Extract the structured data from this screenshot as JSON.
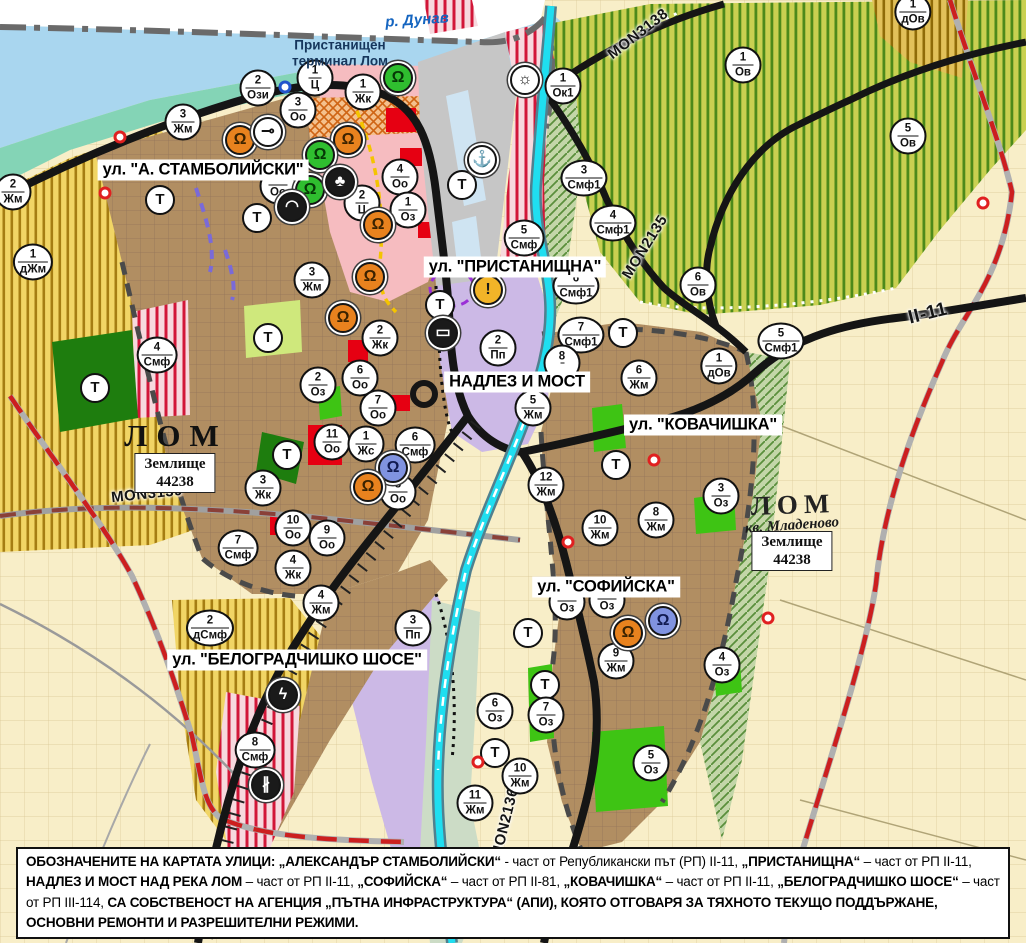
{
  "palette": {
    "residential_brown": "#b18e62",
    "mixed_function_red_stripe": "#d21638",
    "center_pink": "#f6bcc0",
    "production_lavender": "#ccb9e6",
    "park_green": "#3ec414",
    "vineyard_green_stripe": "#4c8a1b",
    "farmland_yellow_stripe": "#a57d12",
    "danube_blue": "#a9d6ef",
    "lom_river_cyan": "#1fdef0",
    "road_black": "#151515",
    "planned_route_red": "#cc1f1f"
  },
  "area_labels": [
    {
      "name": "river-danube-label",
      "t": "р. Дунав",
      "cls": "river-label",
      "x": 417,
      "y": 20,
      "rot": -4
    },
    {
      "name": "port-terminal-label",
      "t": "Пристанищен\nтерминал Лом",
      "cls": "port-label",
      "x": 340,
      "y": 53
    },
    {
      "name": "city-lom-label",
      "t": "ЛОМ",
      "cls": "city-label",
      "x": 176,
      "y": 436
    },
    {
      "name": "zemlishte-44238-label",
      "t": "Землище\n44238",
      "cls": "zemlishte-box",
      "x": 175,
      "y": 473
    },
    {
      "name": "city-lom-mladenovo-label",
      "t": "ЛОМ",
      "cls": "city-label city2",
      "x": 793,
      "y": 505,
      "rot": -2
    },
    {
      "name": "kv-mladenovo-label",
      "t": "кв. Младеново",
      "cls": "kv-label",
      "x": 792,
      "y": 526,
      "rot": -4
    },
    {
      "name": "zemlishte-44238-mladenovo-label",
      "t": "Землище\n44238",
      "cls": "zemlishte-box",
      "x": 792,
      "y": 551
    }
  ],
  "road_labels": [
    {
      "name": "road-label-mon3138",
      "t": "MON3138",
      "x": 638,
      "y": 34,
      "rot": -38
    },
    {
      "name": "road-label-mon2135",
      "t": "MON2135",
      "x": 645,
      "y": 247,
      "rot": -58
    },
    {
      "name": "road-label-mon3139",
      "t": "MON3139",
      "x": 147,
      "y": 494,
      "rot": -6
    },
    {
      "name": "road-label-mon2136",
      "t": "MON2136",
      "x": 505,
      "y": 823,
      "rot": -76
    },
    {
      "name": "road-label-ii-11",
      "t": "II-11",
      "cls": "big",
      "x": 928,
      "y": 314,
      "rot": -14
    }
  ],
  "street_labels": [
    {
      "name": "street-label-stamboliyski",
      "t": "ул. \"А. СТАМБОЛИЙСКИ\"",
      "x": 203,
      "y": 170
    },
    {
      "name": "street-label-pristanishtna",
      "t": "ул. \"ПРИСТАНИЩНА\"",
      "x": 515,
      "y": 267
    },
    {
      "name": "street-label-nadlez-i-most",
      "t": "НАДЛЕЗ И МОСТ",
      "x": 517,
      "y": 382
    },
    {
      "name": "street-label-kovachishka",
      "t": "ул. \"КОВАЧИШКА\"",
      "x": 703,
      "y": 425
    },
    {
      "name": "street-label-sofiyska",
      "t": "ул. \"СОФИЙСКА\"",
      "x": 606,
      "y": 587
    },
    {
      "name": "street-label-belogradchishko",
      "t": "ул. \"БЕЛОГРАДЧИШКО ШОСЕ\"",
      "x": 297,
      "y": 660
    }
  ],
  "zone_markers": [
    {
      "num": "2",
      "abbr": "Ози",
      "x": 258,
      "y": 88
    },
    {
      "num": "1",
      "abbr": "Ц",
      "x": 315,
      "y": 78
    },
    {
      "num": "1",
      "abbr": "Жк",
      "x": 363,
      "y": 92
    },
    {
      "num": "3",
      "abbr": "Оо",
      "x": 298,
      "y": 110
    },
    {
      "num": "3",
      "abbr": "Жм",
      "x": 183,
      "y": 122
    },
    {
      "num": "2",
      "abbr": "Жм",
      "x": 13,
      "y": 192
    },
    {
      "num": "1",
      "abbr": "дЖм",
      "x": 33,
      "y": 262
    },
    {
      "num": "",
      "abbr": "Оо",
      "x": 278,
      "y": 186
    },
    {
      "num": "4",
      "abbr": "Оо",
      "x": 400,
      "y": 177
    },
    {
      "num": "2",
      "abbr": "Ц",
      "x": 362,
      "y": 203
    },
    {
      "num": "1",
      "abbr": "Оз",
      "x": 408,
      "y": 210
    },
    {
      "num": "3",
      "abbr": "Жм",
      "x": 312,
      "y": 280
    },
    {
      "num": "Т",
      "cls": "single",
      "x": 160,
      "y": 200
    },
    {
      "num": "Т",
      "cls": "single",
      "x": 257,
      "y": 218
    },
    {
      "num": "1",
      "abbr": "Ок1",
      "x": 563,
      "y": 86
    },
    {
      "num": "3",
      "abbr": "Смф1",
      "x": 584,
      "y": 178
    },
    {
      "num": "4",
      "abbr": "Смф1",
      "x": 613,
      "y": 223
    },
    {
      "num": "5",
      "abbr": "Смф",
      "x": 524,
      "y": 238
    },
    {
      "num": "6",
      "abbr": "Смф1",
      "x": 576,
      "y": 286
    },
    {
      "num": "1",
      "abbr": "Ов",
      "x": 743,
      "y": 65
    },
    {
      "num": "5",
      "abbr": "Ов",
      "x": 908,
      "y": 136
    },
    {
      "num": "1",
      "abbr": "дОв",
      "x": 913,
      "y": 12
    },
    {
      "num": "6",
      "abbr": "Ов",
      "x": 698,
      "y": 285
    },
    {
      "num": "Т",
      "cls": "single",
      "x": 462,
      "y": 185
    },
    {
      "num": "Т",
      "cls": "single",
      "x": 440,
      "y": 305
    },
    {
      "num": "2",
      "abbr": "Пп",
      "x": 498,
      "y": 348
    },
    {
      "num": "Т",
      "cls": "single",
      "x": 623,
      "y": 333
    },
    {
      "num": "7",
      "abbr": "Смф1",
      "x": 581,
      "y": 335
    },
    {
      "num": "8",
      "abbr": "",
      "x": 562,
      "y": 363
    },
    {
      "num": "5",
      "abbr": "Жм",
      "x": 533,
      "y": 408
    },
    {
      "num": "6",
      "abbr": "Жм",
      "x": 639,
      "y": 378
    },
    {
      "num": "1",
      "abbr": "дОв",
      "x": 719,
      "y": 366
    },
    {
      "num": "5",
      "abbr": "Смф1",
      "x": 781,
      "y": 341
    },
    {
      "num": "12",
      "abbr": "Жм",
      "x": 546,
      "y": 485
    },
    {
      "num": "10",
      "abbr": "Жм",
      "x": 600,
      "y": 528
    },
    {
      "num": "8",
      "abbr": "Жм",
      "x": 656,
      "y": 520
    },
    {
      "num": "3",
      "abbr": "Оз",
      "x": 721,
      "y": 496
    },
    {
      "num": "Т",
      "cls": "single",
      "x": 616,
      "y": 465
    },
    {
      "num": "4",
      "abbr": "Смф",
      "x": 157,
      "y": 355
    },
    {
      "num": "Т",
      "cls": "single",
      "x": 95,
      "y": 388
    },
    {
      "num": "Т",
      "cls": "single",
      "x": 268,
      "y": 338
    },
    {
      "num": "Т",
      "cls": "single",
      "x": 287,
      "y": 455
    },
    {
      "num": "2",
      "abbr": "Оз",
      "x": 318,
      "y": 385
    },
    {
      "num": "6",
      "abbr": "Оо",
      "x": 360,
      "y": 378
    },
    {
      "num": "2",
      "abbr": "Жк",
      "x": 380,
      "y": 338
    },
    {
      "num": "7",
      "abbr": "Оо",
      "x": 378,
      "y": 408
    },
    {
      "num": "11",
      "abbr": "Оо",
      "x": 332,
      "y": 442
    },
    {
      "num": "1",
      "abbr": "Жс",
      "x": 366,
      "y": 444
    },
    {
      "num": "6",
      "abbr": "Смф",
      "x": 415,
      "y": 445
    },
    {
      "num": "8",
      "abbr": "Оо",
      "x": 398,
      "y": 492
    },
    {
      "num": "3",
      "abbr": "Жк",
      "x": 263,
      "y": 488
    },
    {
      "num": "10",
      "abbr": "Оо",
      "x": 293,
      "y": 528
    },
    {
      "num": "9",
      "abbr": "Оо",
      "x": 327,
      "y": 538
    },
    {
      "num": "7",
      "abbr": "Смф",
      "x": 238,
      "y": 548
    },
    {
      "num": "4",
      "abbr": "Жк",
      "x": 293,
      "y": 568
    },
    {
      "num": "4",
      "abbr": "Жм",
      "x": 321,
      "y": 603
    },
    {
      "num": "2",
      "abbr": "дСмф",
      "x": 210,
      "y": 628
    },
    {
      "num": "3",
      "abbr": "Пп",
      "x": 413,
      "y": 628
    },
    {
      "num": "8",
      "abbr": "Смф",
      "x": 255,
      "y": 750
    },
    {
      "num": "6",
      "abbr": "Оз",
      "x": 495,
      "y": 711
    },
    {
      "num": "Т",
      "cls": "single",
      "x": 495,
      "y": 753
    },
    {
      "num": "11",
      "abbr": "Жм",
      "x": 475,
      "y": 803
    },
    {
      "num": "Т",
      "cls": "single",
      "x": 528,
      "y": 633
    },
    {
      "num": "Т",
      "cls": "single",
      "x": 545,
      "y": 685
    },
    {
      "num": "7",
      "abbr": "Оз",
      "x": 546,
      "y": 715
    },
    {
      "num": "10",
      "abbr": "Жм",
      "x": 520,
      "y": 776
    },
    {
      "num": "9",
      "abbr": "Жм",
      "x": 616,
      "y": 661
    },
    {
      "num": "5",
      "abbr": "Оз",
      "x": 651,
      "y": 763
    },
    {
      "num": "4",
      "abbr": "Оз",
      "x": 722,
      "y": 665
    },
    {
      "num": "",
      "abbr": "Оз",
      "x": 567,
      "y": 602
    },
    {
      "num": "",
      "abbr": "Оз",
      "x": 607,
      "y": 600
    }
  ],
  "poi_markers": [
    {
      "name": "landmark-icon-green",
      "glyph": "Ω",
      "bg": "#2fbe2f",
      "fg": "#063806",
      "x": 398,
      "y": 78
    },
    {
      "name": "landmark-icon-orange",
      "glyph": "Ω",
      "bg": "#e8821e",
      "fg": "#3a2200",
      "x": 240,
      "y": 140
    },
    {
      "name": "landmark-icon-orange",
      "glyph": "Ω",
      "bg": "#e8821e",
      "fg": "#3a2200",
      "x": 348,
      "y": 140
    },
    {
      "name": "key-icon",
      "glyph": "⊸",
      "bg": "#ffffff",
      "fg": "#111111",
      "x": 268,
      "y": 132
    },
    {
      "name": "landmark-icon-green",
      "glyph": "Ω",
      "bg": "#2fbe2f",
      "fg": "#063806",
      "x": 320,
      "y": 155
    },
    {
      "name": "landmark-icon-green",
      "glyph": "Ω",
      "bg": "#2fbe2f",
      "fg": "#063806",
      "x": 310,
      "y": 190
    },
    {
      "name": "club-icon",
      "glyph": "♣",
      "bg": "#1a1a1a",
      "fg": "#ffffff",
      "x": 340,
      "y": 182
    },
    {
      "name": "arch-icon",
      "glyph": "◠",
      "bg": "#1a1a1a",
      "fg": "#ffffff",
      "x": 292,
      "y": 207
    },
    {
      "name": "landmark-icon-orange",
      "glyph": "Ω",
      "bg": "#e8821e",
      "fg": "#3a2200",
      "x": 378,
      "y": 225
    },
    {
      "name": "landmark-icon-orange",
      "glyph": "Ω",
      "bg": "#e8821e",
      "fg": "#3a2200",
      "x": 370,
      "y": 277
    },
    {
      "name": "landmark-icon-orange",
      "glyph": "Ω",
      "bg": "#e8821e",
      "fg": "#3a2200",
      "x": 343,
      "y": 318
    },
    {
      "name": "truck-icon",
      "glyph": "▭",
      "bg": "#1a1a1a",
      "fg": "#ffffff",
      "x": 443,
      "y": 333
    },
    {
      "name": "anchor-icon",
      "glyph": "⚓",
      "bg": "#ffffff",
      "fg": "#111111",
      "x": 482,
      "y": 160
    },
    {
      "name": "sun-icon",
      "glyph": "☼",
      "bg": "#ffffff",
      "fg": "#111111",
      "x": 525,
      "y": 80
    },
    {
      "name": "warning-icon",
      "glyph": "!",
      "bg": "#f2b428",
      "fg": "#1a1a1a",
      "x": 488,
      "y": 290
    },
    {
      "name": "landmark-icon-blue",
      "glyph": "Ω",
      "bg": "#8093e0",
      "fg": "#101a50",
      "x": 393,
      "y": 468
    },
    {
      "name": "landmark-icon-orange",
      "glyph": "Ω",
      "bg": "#e8821e",
      "fg": "#3a2200",
      "x": 368,
      "y": 487
    },
    {
      "name": "lightning-icon",
      "glyph": "ϟ",
      "bg": "#1a1a1a",
      "fg": "#ffffff",
      "x": 283,
      "y": 695
    },
    {
      "name": "railway-crossing-icon",
      "glyph": "∦",
      "bg": "#1a1a1a",
      "fg": "#ffffff",
      "x": 266,
      "y": 785
    },
    {
      "name": "landmark-icon-orange",
      "glyph": "Ω",
      "bg": "#e8821e",
      "fg": "#3a2200",
      "x": 628,
      "y": 633
    },
    {
      "name": "landmark-icon-blue",
      "glyph": "Ω",
      "bg": "#8093e0",
      "fg": "#101a50",
      "x": 663,
      "y": 621
    },
    {
      "name": "red-dot-marker",
      "cls": "dot",
      "glyph": "",
      "ring": "#e02020",
      "x": 654,
      "y": 460
    },
    {
      "name": "red-dot-marker",
      "cls": "dot",
      "glyph": "",
      "ring": "#e02020",
      "x": 568,
      "y": 542
    },
    {
      "name": "red-dot-marker",
      "cls": "dot",
      "glyph": "",
      "ring": "#e02020",
      "x": 768,
      "y": 618
    },
    {
      "name": "red-dot-marker",
      "cls": "dot",
      "glyph": "",
      "ring": "#e02020",
      "x": 478,
      "y": 762
    },
    {
      "name": "red-dot-marker",
      "cls": "dot",
      "glyph": "",
      "ring": "#e02020",
      "x": 983,
      "y": 203
    },
    {
      "name": "red-dot-marker",
      "cls": "dot",
      "glyph": "",
      "ring": "#e02020",
      "x": 120,
      "y": 137
    },
    {
      "name": "red-dot-marker",
      "cls": "dot",
      "glyph": "",
      "ring": "#e02020",
      "x": 105,
      "y": 193
    },
    {
      "name": "blue-dot-marker",
      "cls": "dot",
      "glyph": "",
      "ring": "#2255cc",
      "x": 285,
      "y": 87
    }
  ],
  "footer_segments": [
    {
      "t": "ОБОЗНАЧЕНИТЕ НА КАРТАТА УЛИЦИ: „АЛЕКСАНДЪР СТАМБОЛИЙСКИ“",
      "cls": "b"
    },
    {
      "t": " - част от Републикански път (РП) II-11, "
    },
    {
      "t": "„ПРИСТАНИЩНА“",
      "cls": "b"
    },
    {
      "t": " – част от РП II-11, "
    },
    {
      "t": "НАДЛЕЗ И МОСТ НАД РЕКА ЛОМ",
      "cls": "b"
    },
    {
      "t": " – част от РП II-11, "
    },
    {
      "t": "„СОФИЙСКА“",
      "cls": "b"
    },
    {
      "t": " – част от РП II-81, "
    },
    {
      "t": "„КОВАЧИШКА“",
      "cls": "b"
    },
    {
      "t": " – част от РП II-11, "
    },
    {
      "t": "„БЕЛОГРАДЧИШКО ШОСЕ“",
      "cls": "b"
    },
    {
      "t": " – част от РП III-114, "
    },
    {
      "t": "СА СОБСТВЕНОСТ НА АГЕНЦИЯ „ПЪТНА ИНФРАСТРУКТУРА“ (АПИ), КОЯТО ОТГОВАРЯ ЗА ТЯХНОТО ТЕКУЩО ПОДДЪРЖАНЕ, ОСНОВНИ РЕМОНТИ И РАЗРЕШИТЕЛНИ РЕЖИМИ.",
      "cls": "b"
    }
  ]
}
